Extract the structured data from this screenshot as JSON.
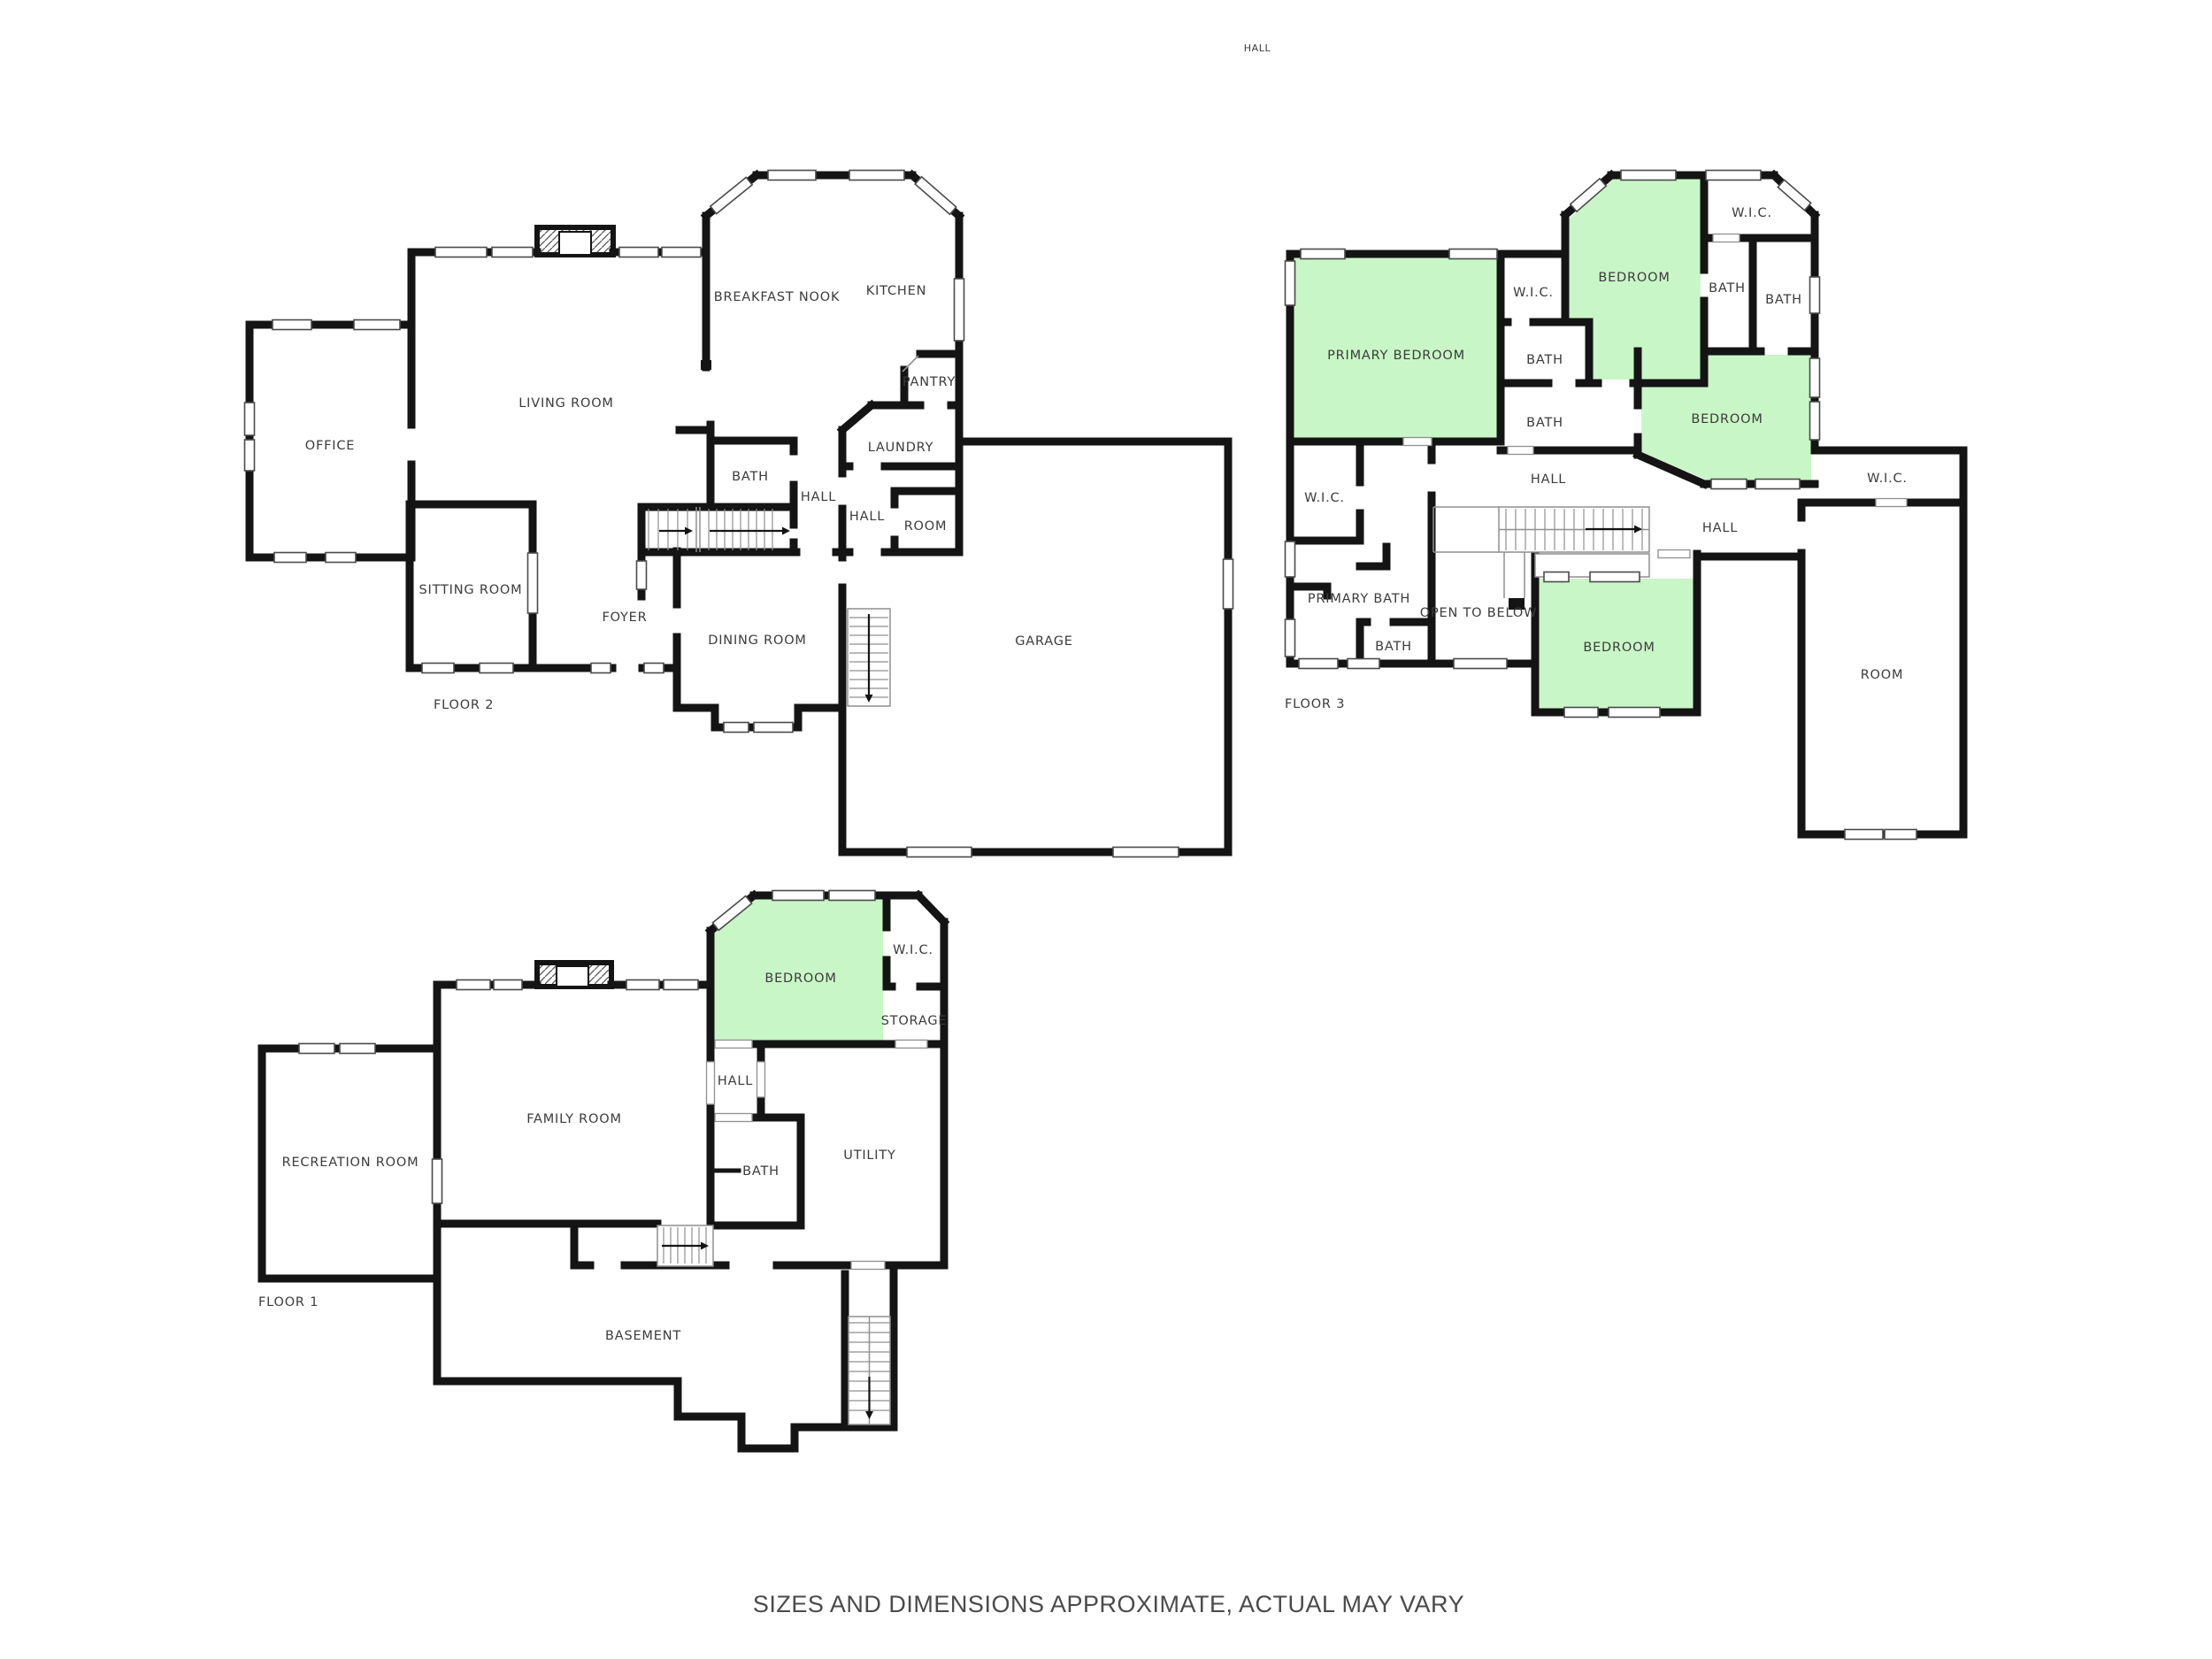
{
  "image_type": "residential-floor-plan",
  "stray_label": "HALL",
  "footer": {
    "disclaimer": "SIZES AND DIMENSIONS APPROXIMATE, ACTUAL MAY VARY"
  },
  "colors": {
    "background": "#ffffff",
    "wall": "#141414",
    "bedroom_fill": "#c9f6c7",
    "label_text": "#3b3b3b",
    "footer_text": "#4a4a4a"
  },
  "floor2": {
    "name": "FLOOR 2",
    "rooms": {
      "office": "OFFICE",
      "living_room": "LIVING ROOM",
      "breakfast_nook": "BREAKFAST NOOK",
      "kitchen": "KITCHEN",
      "pantry": "PANTRY",
      "laundry": "LAUNDRY",
      "bath": "BATH",
      "hall_west": "HALL",
      "hall_corridor": "HALL",
      "room": "ROOM",
      "sitting_room": "SITTING ROOM",
      "foyer": "FOYER",
      "dining_room": "DINING ROOM",
      "garage": "GARAGE"
    }
  },
  "floor3": {
    "name": "FLOOR 3",
    "rooms": {
      "primary_bedroom": "PRIMARY BEDROOM",
      "wic_center": "W.I.C.",
      "bedroom_top": "BEDROOM",
      "wic_top_right": "W.I.C.",
      "bath_a": "BATH",
      "bath_b": "BATH",
      "bath_c": "BATH",
      "bath_d": "BATH",
      "bedroom_right": "BEDROOM",
      "wic_left": "W.I.C.",
      "hall_center": "HALL",
      "hall_right": "HALL",
      "wic_right": "W.I.C.",
      "primary_bath": "PRIMARY BATH",
      "open_to_below": "OPEN TO BELOW",
      "bath_e": "BATH",
      "bedroom_bottom": "BEDROOM",
      "room": "ROOM"
    }
  },
  "floor1": {
    "name": "FLOOR 1",
    "rooms": {
      "recreation_room": "RECREATION ROOM",
      "family_room": "FAMILY ROOM",
      "bedroom": "BEDROOM",
      "wic": "W.I.C.",
      "storage": "STORAGE",
      "hall": "HALL",
      "bath": "BATH",
      "utility": "UTILITY",
      "basement": "BASEMENT"
    }
  }
}
